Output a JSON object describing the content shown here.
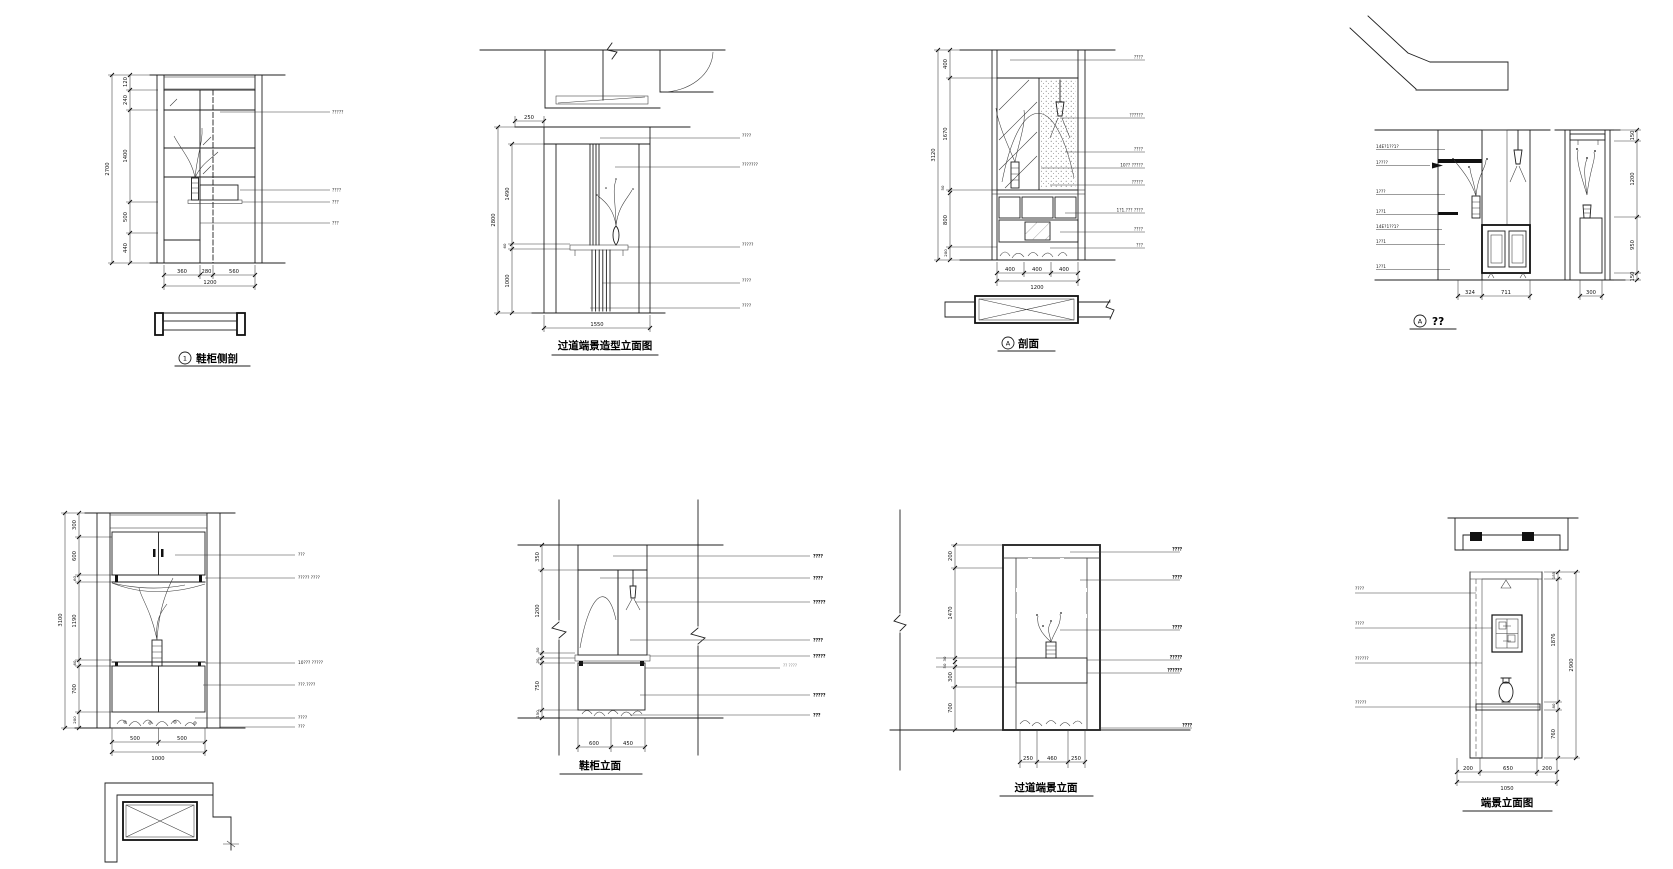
{
  "page": {
    "background": "#ffffff",
    "line_color": "#1f1f1f"
  },
  "drawings": [
    {
      "id": "d1",
      "title": "鞋柜侧剖",
      "title_marker": "1",
      "dims_left_overall": "2700",
      "dims_left": [
        "120",
        "240",
        "1400",
        "500",
        "440"
      ],
      "dims_bottom": [
        "360",
        "280",
        "560"
      ],
      "dims_bottom_total": "1200",
      "labels_right": [
        "?????",
        "????",
        "???",
        "???"
      ]
    },
    {
      "id": "d2",
      "title": "过道端景造型立面图",
      "dim_top": "250",
      "dims_left_overall": "2800",
      "dims_left": [
        "1490",
        "60",
        "1000"
      ],
      "dims_bottom_total": "1550",
      "labels_right": [
        "????",
        "???????",
        "?????",
        "????",
        "????"
      ]
    },
    {
      "id": "d3",
      "title": "剖面",
      "title_marker": "A",
      "dims_left_overall": "3120",
      "dims_left": [
        "400",
        "1670",
        "50",
        "800",
        "200"
      ],
      "dims_bottom": [
        "400",
        "400",
        "400"
      ],
      "dims_bottom_total": "1200",
      "labels_right": [
        "????",
        "??????",
        "????",
        "10?? ?????",
        "?????",
        "1?1.??? ????",
        "????",
        "???"
      ]
    },
    {
      "id": "d4",
      "title": "??",
      "title_marker": "A",
      "labels_left": [
        "14E?1??1?",
        "1????",
        "1???",
        "1??1",
        "14E?1??1?",
        "1??1",
        "1??1"
      ],
      "dims_bottom": [
        "324",
        "711"
      ],
      "side_dim_bottom": "300",
      "dims_right": [
        "150",
        "1200",
        "950",
        "150"
      ]
    },
    {
      "id": "d5",
      "dims_left_overall": "3100",
      "dims_left": [
        "300",
        "600",
        "60",
        "1190",
        "60",
        "700",
        "200"
      ],
      "dims_bottom": [
        "500",
        "500"
      ],
      "dims_bottom_total": "1000",
      "labels_right": [
        "???",
        "????? ????",
        "10??? ?????",
        "???.????",
        "????",
        "???"
      ]
    },
    {
      "id": "d6",
      "title": "鞋柜立面",
      "dims_left": [
        "350",
        "1200",
        "50",
        "30",
        "750",
        "150"
      ],
      "dims_bottom": [
        "600",
        "450"
      ],
      "labels_right": [
        "????",
        "????",
        "?????",
        "????",
        "?????",
        "?? ????",
        "?????",
        "???"
      ]
    },
    {
      "id": "d7",
      "title": "过道端景立面",
      "dims_left": [
        "200",
        "1470",
        "30",
        "50",
        "300",
        "700"
      ],
      "dims_bottom": [
        "250",
        "460",
        "250"
      ],
      "labels_right": [
        "????",
        "????",
        "????",
        "?????",
        "??????",
        "????"
      ]
    },
    {
      "id": "d8",
      "title": "端景立面图",
      "labels_left": [
        "????",
        "????",
        "??????",
        "?????"
      ],
      "dims_right": [
        "185",
        "1876",
        "80",
        "760"
      ],
      "dims_right_overall": "2900",
      "dims_bottom": [
        "200",
        "650",
        "200"
      ],
      "dims_bottom_total": "1050"
    }
  ]
}
